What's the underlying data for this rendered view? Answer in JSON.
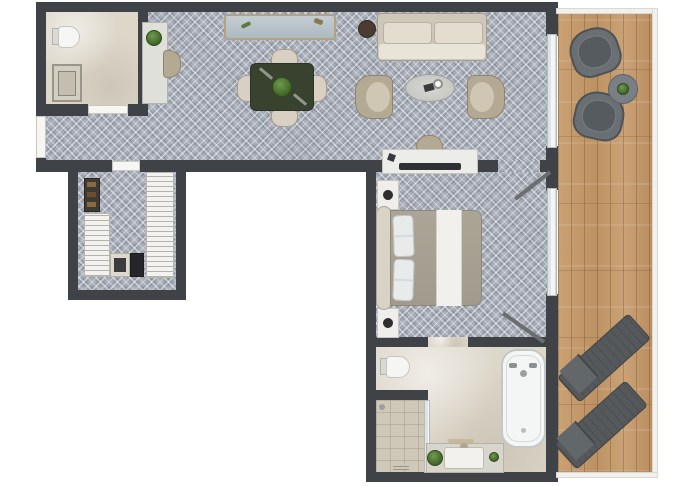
{
  "document": {
    "kind": "apartment-floor-plan",
    "visible_text": "",
    "orientation": "top-down",
    "shape": "L-shaped unit with full-height balcony on the right"
  },
  "palette": {
    "background": "#ffffff",
    "wall": "#3f4246",
    "carpet": "#a9afb9",
    "marble_floor": "#ddd7ca",
    "shower_floor": "#cfc8b8",
    "wood_deck": "#c49a6c",
    "glass": "#e8eeee",
    "white_fixture": "#f4f6f5",
    "cream_fabric": "#d8d1c3",
    "taupe_fabric": "#b4a993",
    "dining_table": "#39422f",
    "outdoor_grey": "#55595c",
    "plant_green": "#4d7334"
  },
  "rooms": {
    "guest_bathroom": {
      "name": "guest bathroom",
      "furniture": [
        "toilet",
        "shower"
      ]
    },
    "living_dining": {
      "name": "living and dining area",
      "furniture": [
        "console desk",
        "desk chair",
        "sideboard",
        "dining table",
        "4 dining chairs",
        "sofa",
        "side table",
        "coffee table",
        "2 armchairs",
        "tv console",
        "tv",
        "desk chair"
      ]
    },
    "closet": {
      "name": "walk-in closet",
      "furniture": [
        "shelf unit",
        "left wardrobe",
        "right wardrobe",
        "safe",
        "minibar"
      ]
    },
    "bedroom": {
      "name": "bedroom",
      "furniture": [
        "double bed",
        "headboard",
        "2 pillows",
        "2 nightstands",
        "2 table lamps"
      ]
    },
    "main_bathroom": {
      "name": "main bathroom",
      "furniture": [
        "toilet",
        "bathtub",
        "vanity with sink",
        "walk-in shower",
        "2 plants"
      ]
    },
    "balcony": {
      "name": "balcony terrace",
      "furniture": [
        "2 outdoor chairs",
        "round side table",
        "plant",
        "2 sun loungers"
      ]
    }
  },
  "openings": {
    "entry_door": "left wall of hallway",
    "guest_bathroom_door": "bottom wall of guest bathroom",
    "closet_door": "top wall of walk-in closet",
    "bedroom_door": "wall between living area and bedroom",
    "bathroom_door": "wall between bedroom and main bathroom",
    "windows": [
      "living room sliding glass door to balcony",
      "bedroom sliding glass door to balcony"
    ]
  }
}
